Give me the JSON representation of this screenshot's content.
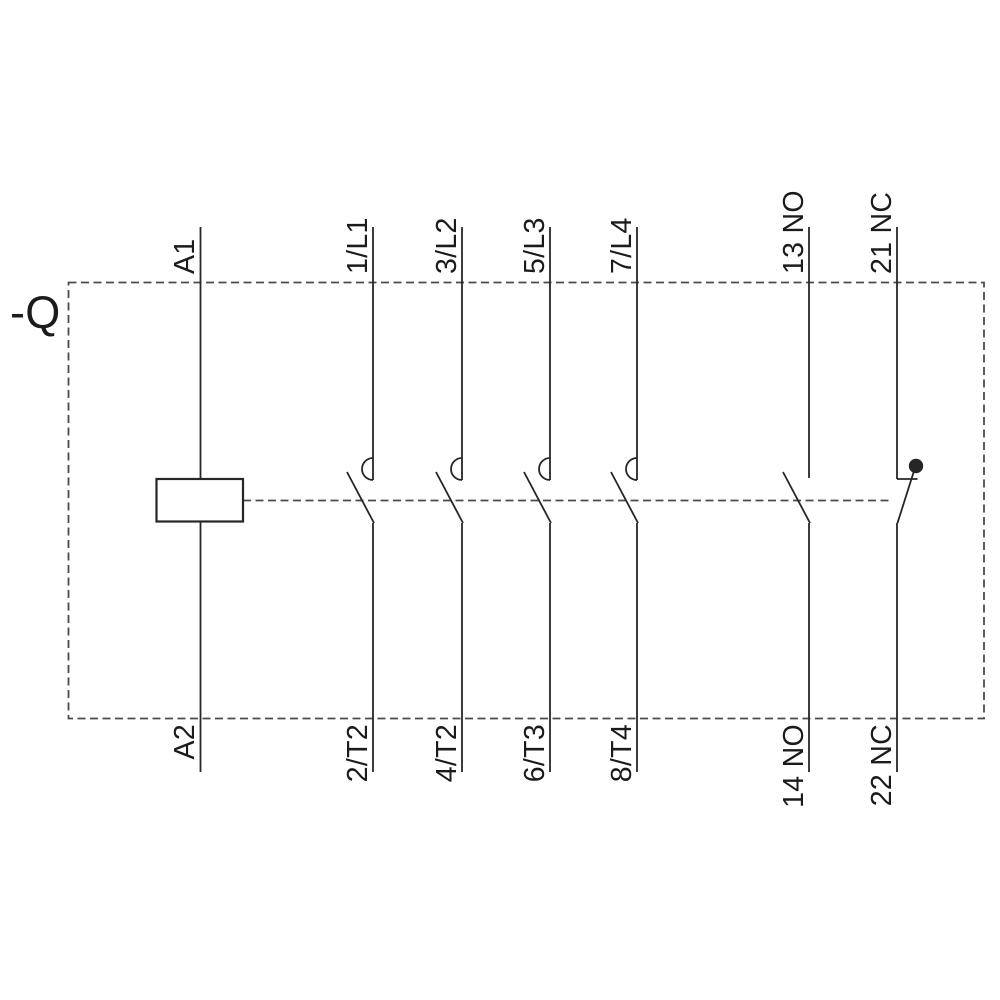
{
  "device_label": "-Q",
  "coil": {
    "top": "A1",
    "bottom": "A2"
  },
  "poles": [
    {
      "top": "1/L1",
      "bottom": "2/T2"
    },
    {
      "top": "3/L2",
      "bottom": "4/T2"
    },
    {
      "top": "5/L3",
      "bottom": "6/T3"
    },
    {
      "top": "7/L4",
      "bottom": "8/T4"
    }
  ],
  "aux": [
    {
      "top": "13 NO",
      "bottom": "14 NO",
      "type": "NO"
    },
    {
      "top": "21 NC",
      "bottom": "22 NC",
      "type": "NC"
    }
  ],
  "symbols": {
    "coil": "coil-box",
    "main_contact": "no-contact-with-arc-chute",
    "nc_mirror_dot": "filled-circle",
    "mechanical_link": "dashed-line",
    "enclosure": "dashed-border"
  },
  "colors": {
    "line": "#262626",
    "dashed": "#4b4b4b",
    "text": "#1b1b1b",
    "background": "#ffffff"
  }
}
